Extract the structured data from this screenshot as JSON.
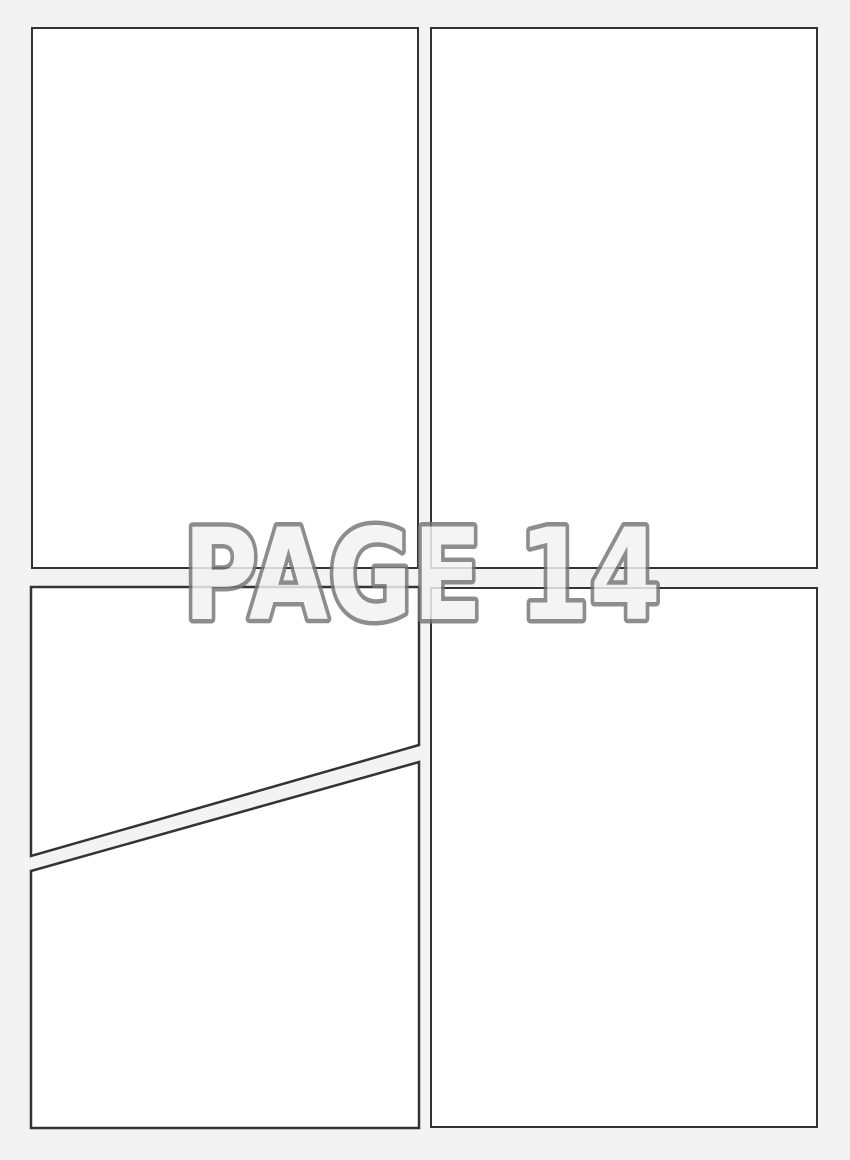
{
  "watermark": {
    "label": "PAGE 14"
  },
  "colors": {
    "background": "#f3f3f3",
    "panel_fill": "#ffffff",
    "panel_border": "#333333",
    "watermark_outline": "#787878",
    "watermark_fill": "#f2f2f2"
  }
}
